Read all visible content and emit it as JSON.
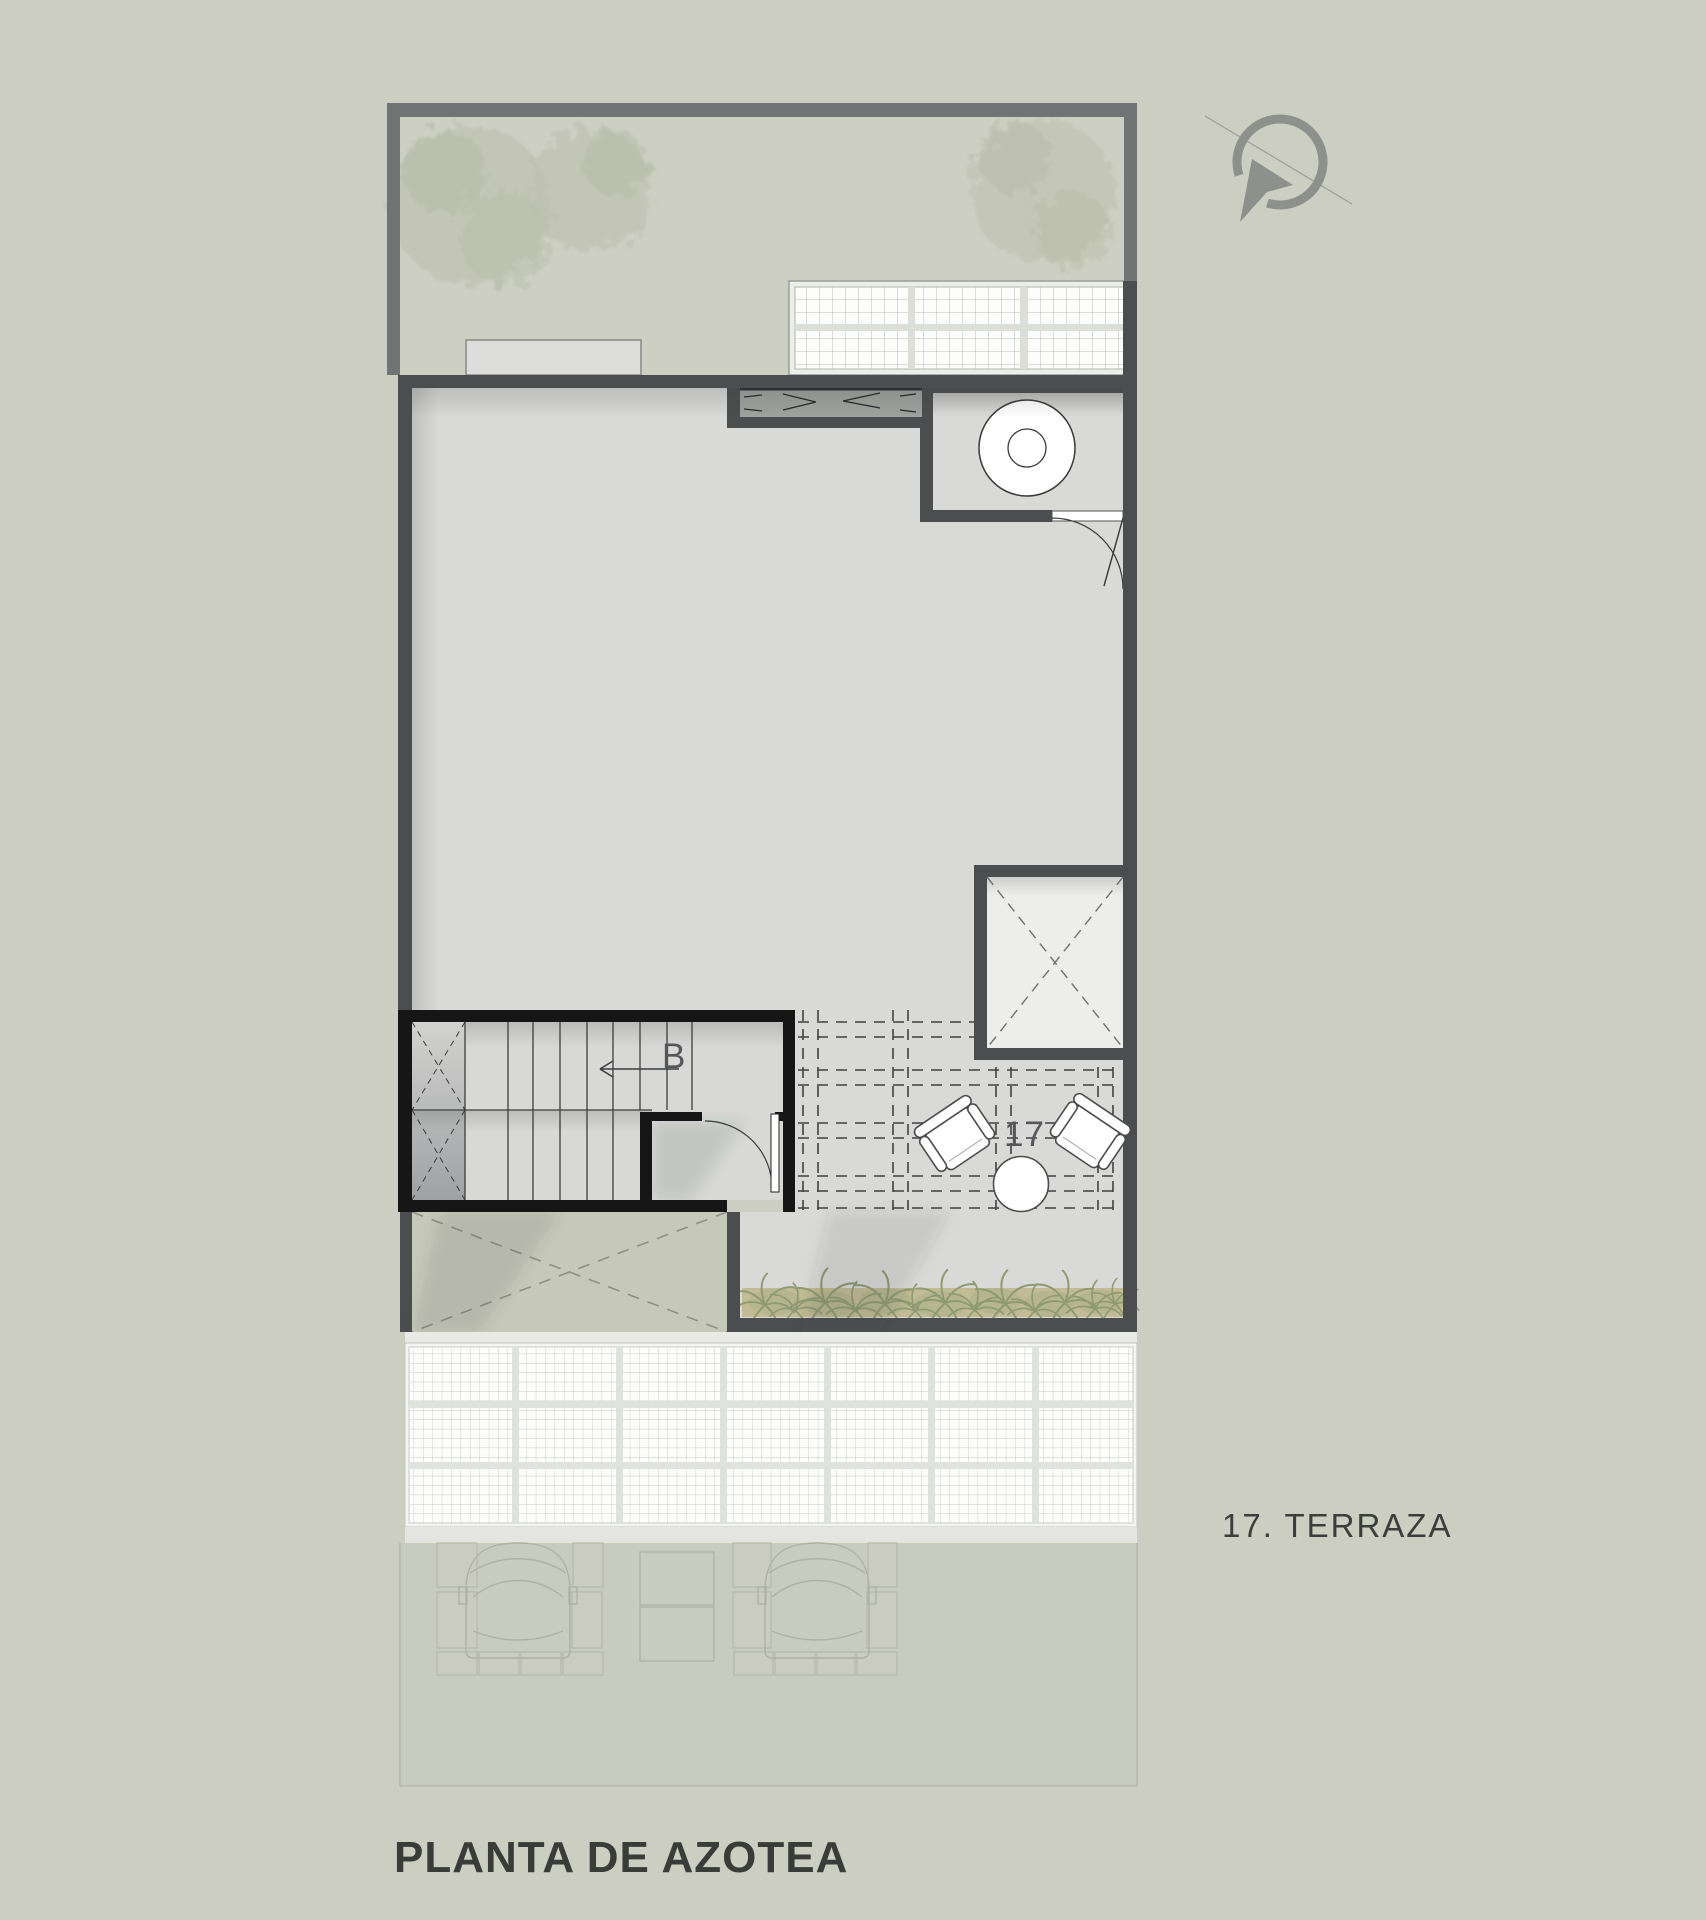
{
  "title": {
    "text": "PLANTA DE AZOTEA"
  },
  "legend": {
    "text": "17. TERRAZA"
  },
  "plan": {
    "terrace_number": "17",
    "stairs": {
      "direction_label": "B"
    }
  },
  "icons": {
    "north_arrow": "north-arrow-icon",
    "tree": "tree-icon",
    "washing_machine": "washing-machine-icon",
    "fern": "fern-icon",
    "car": "car-outline-icon"
  },
  "colors": {
    "background": "#cbcec1",
    "roof_slab": "#d9d9d7",
    "boundary_wall": "#717375",
    "building_wall": "#4b4d4f",
    "stair_wall": "#161617",
    "skylight_fill": "#ededeb",
    "void_fill": "#c6c9b9",
    "planter": "#c1bc93",
    "fern": "#8f9a72",
    "grid_panel": "#fdfdfc",
    "grid_mullion": "#e0e2dd",
    "ghost_line": "#aeb2a4",
    "text": "#3a3c38"
  }
}
